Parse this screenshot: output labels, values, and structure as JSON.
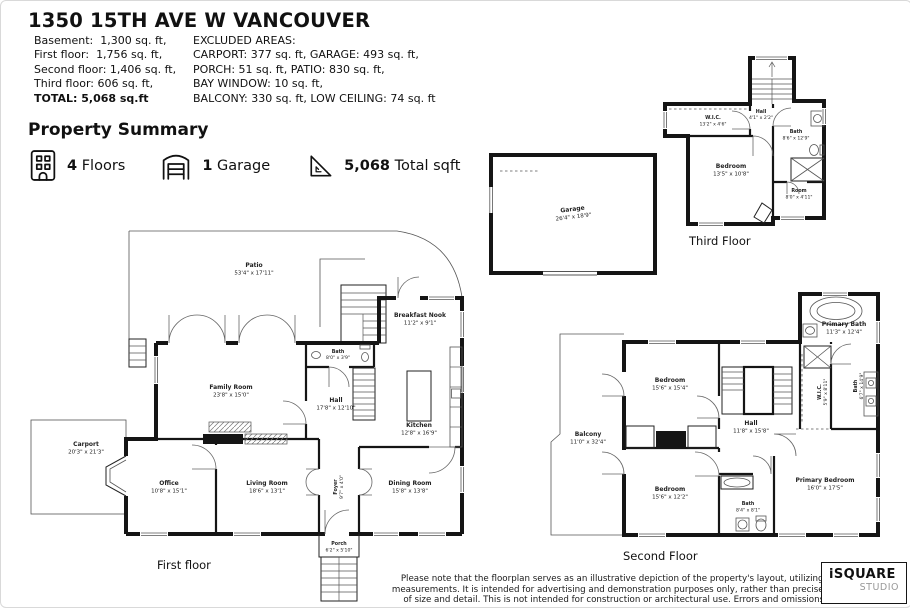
{
  "header": {
    "title": "1350 15TH AVE W VANCOUVER",
    "left_lines": [
      "Basement:  1,300 sq. ft,",
      "First floor:  1,756 sq. ft,",
      "Second floor: 1,406 sq. ft,",
      "Third floor: 606 sq. ft,"
    ],
    "total_line": "TOTAL: 5,068 sq.ft",
    "right_lines": [
      "EXCLUDED AREAS:",
      "CARPORT: 377 sq. ft, GARAGE: 493 sq. ft,",
      "PORCH: 51 sq. ft, PATIO: 830 sq. ft,",
      "BAY WINDOW: 10 sq. ft,",
      "BALCONY: 330 sq. ft, LOW CEILING: 74 sq. ft"
    ]
  },
  "summary": {
    "heading": "Property Summary",
    "floors_value": "4",
    "floors_label": "Floors",
    "garage_value": "1",
    "garage_label": "Garage",
    "sqft_value": "5,068",
    "sqft_label": "Total sqft"
  },
  "plans": {
    "first": {
      "label": "First floor",
      "rooms": {
        "patio": {
          "name": "Patio",
          "dims": "53'4\" x 17'11\""
        },
        "breakfast_nook": {
          "name": "Breakfast Nook",
          "dims": "11'2\" x 9'1\""
        },
        "bath": {
          "name": "Bath",
          "dims": "8'0\" x 3'9\""
        },
        "family_room": {
          "name": "Family Room",
          "dims": "23'8\" x 15'0\""
        },
        "hall": {
          "name": "Hall",
          "dims": "17'8\" x 12'10\""
        },
        "kitchen": {
          "name": "Kitchen",
          "dims": "12'8\" x 16'9\""
        },
        "carport": {
          "name": "Carport",
          "dims": "20'3\" x 21'3\""
        },
        "office": {
          "name": "Office",
          "dims": "10'8\" x 15'1\""
        },
        "living_room": {
          "name": "Living Room",
          "dims": "18'6\" x 13'1\""
        },
        "foyer": {
          "name": "Foyer",
          "dims": "9'7\" x 4'0\""
        },
        "dining_room": {
          "name": "Dining Room",
          "dims": "15'8\" x 13'8\""
        },
        "porch": {
          "name": "Porch",
          "dims": "6'2\" x 5'10\""
        }
      }
    },
    "second": {
      "label": "Second Floor",
      "rooms": {
        "primary_bath": {
          "name": "Primary Bath",
          "dims": "11'3\" x 12'4\""
        },
        "bedroom_top": {
          "name": "Bedroom",
          "dims": "15'6\" x 15'4\""
        },
        "balcony": {
          "name": "Balcony",
          "dims": "11'0\" x 32'4\""
        },
        "hall": {
          "name": "Hall",
          "dims": "11'8\" x 15'8\""
        },
        "wic": {
          "name": "W.I.C.",
          "dims": "5'9\" x 8'11\""
        },
        "bath_side": {
          "name": "Bath",
          "dims": "6'7\" x 14'9\""
        },
        "bedroom_bottom": {
          "name": "Bedroom",
          "dims": "15'6\" x 12'2\""
        },
        "bath_center": {
          "name": "Bath",
          "dims": "8'4\" x 8'1\""
        },
        "primary_bedroom": {
          "name": "Primary Bedroom",
          "dims": "16'0\" x 17'5\""
        }
      }
    },
    "third": {
      "label": "Third Floor",
      "rooms": {
        "wic": {
          "name": "W.I.C.",
          "dims": "13'2\" x 4'6\""
        },
        "hall": {
          "name": "Hall",
          "dims": "4'1\" x 2'2\""
        },
        "bath": {
          "name": "Bath",
          "dims": "8'6\" x 12'9\""
        },
        "bedroom": {
          "name": "Bedroom",
          "dims": "13'5\" x 10'8\""
        },
        "room": {
          "name": "Room",
          "dims": "8'0\" x 4'11\""
        }
      }
    },
    "garage": {
      "rooms": {
        "garage": {
          "name": "Garage",
          "dims": "26'4\" x 18'9\""
        }
      }
    }
  },
  "footer": {
    "disclaimer_lines": [
      "Please note that the floorplan serves as an illustrative depiction of the property's layout, utilizing approximate",
      "measurements.  It is intended for advertising and demonstration purposes only, rather than precise representation",
      "of size and detail. This is not intended for construction or architectural use. Errors and omissions are insured."
    ],
    "logo_primary": "iSQUARE",
    "logo_secondary": "STUDIO"
  },
  "colors": {
    "wall": "#151515",
    "background": "#ffffff"
  }
}
